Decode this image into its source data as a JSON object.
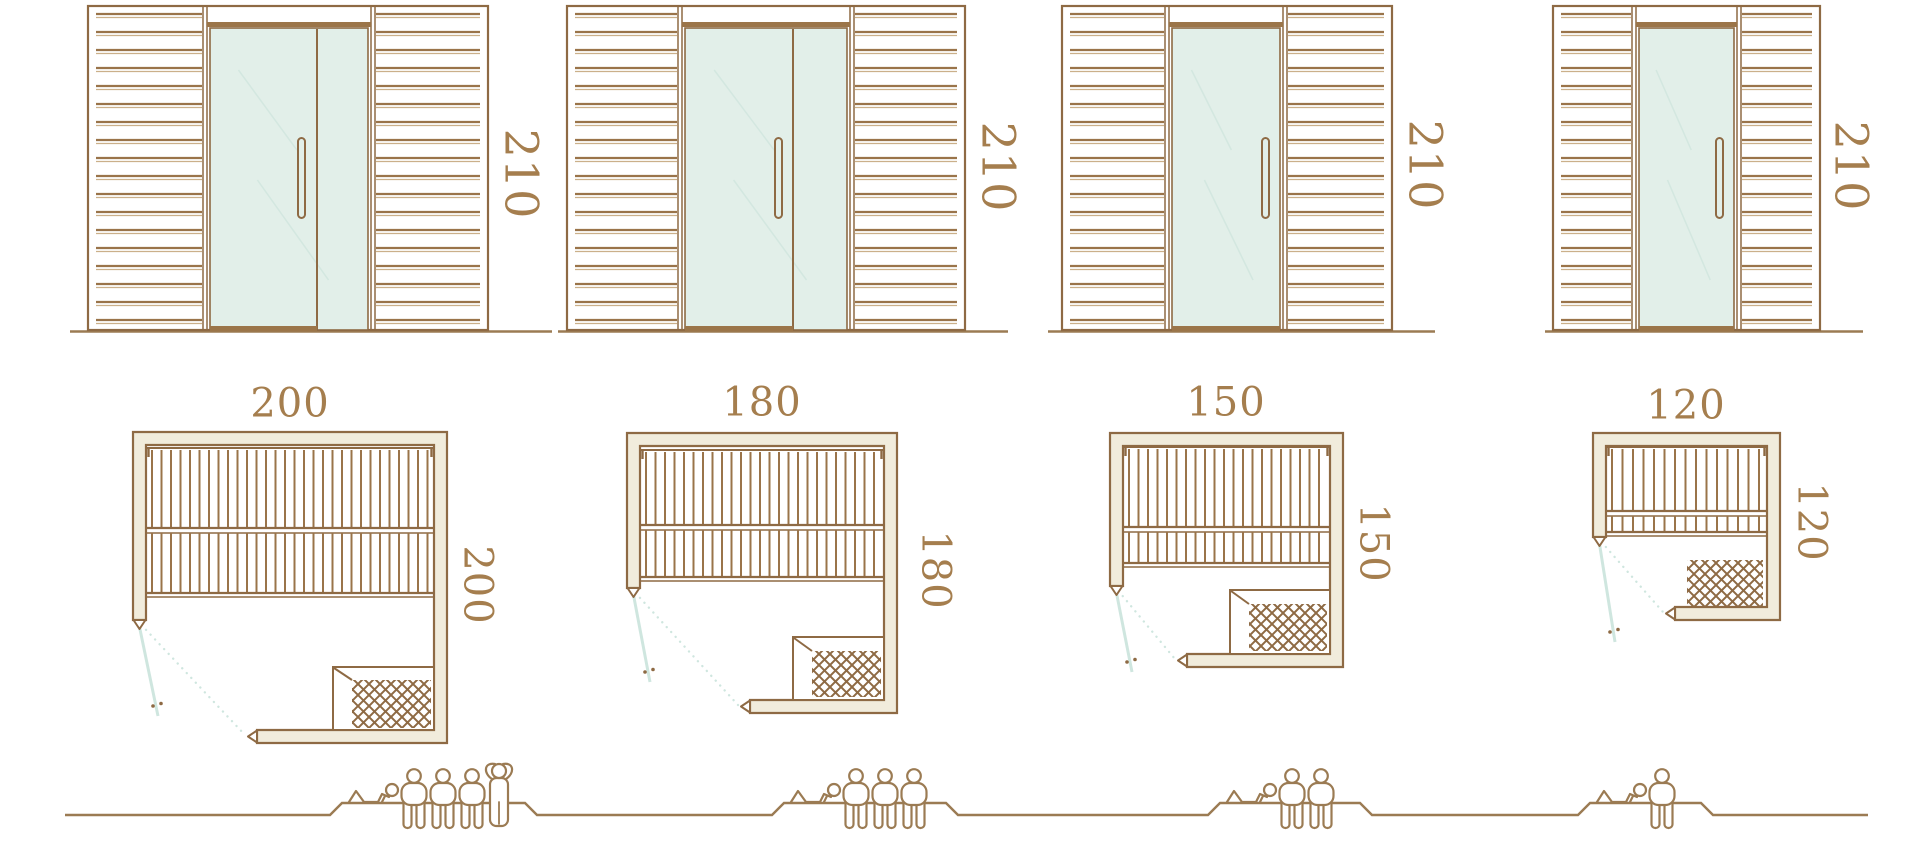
{
  "diagram_title": "sauna-cabin-size-comparison",
  "palette": {
    "line": "#8e6a44",
    "slat": "#9a744a",
    "slat_light": "#cbb08a",
    "wall_fill": "#f1ecdc",
    "glass_fill": "#e2efe9",
    "glass_line": "#8e6a44",
    "reflection": "#d3e7e0",
    "door_swing": "#cfe6df",
    "wood_dark": "#9b7549",
    "ground": "#9b7b53",
    "label": "#a57e4e",
    "background": "#ffffff"
  },
  "units": [
    {
      "id": "200",
      "labels": {
        "height": "210",
        "width": "200",
        "depth": "200"
      },
      "dimensions_cm": {
        "height": 210,
        "width": 200,
        "depth": 200
      },
      "door_glass_panels": 2,
      "heater_framed": true,
      "capacity": {
        "lying": 1,
        "seated": 3,
        "standing": 1,
        "total": 5
      }
    },
    {
      "id": "180",
      "labels": {
        "height": "210",
        "width": "180",
        "depth": "180"
      },
      "dimensions_cm": {
        "height": 210,
        "width": 180,
        "depth": 180
      },
      "door_glass_panels": 2,
      "heater_framed": true,
      "capacity": {
        "lying": 1,
        "seated": 3,
        "standing": 0,
        "total": 4
      }
    },
    {
      "id": "150",
      "labels": {
        "height": "210",
        "width": "150",
        "depth": "150"
      },
      "dimensions_cm": {
        "height": 210,
        "width": 150,
        "depth": 150
      },
      "door_glass_panels": 1,
      "heater_framed": true,
      "capacity": {
        "lying": 1,
        "seated": 2,
        "standing": 0,
        "total": 3
      }
    },
    {
      "id": "120",
      "labels": {
        "height": "210",
        "width": "120",
        "depth": "120"
      },
      "dimensions_cm": {
        "height": 210,
        "width": 120,
        "depth": 120
      },
      "door_glass_panels": 1,
      "heater_framed": false,
      "capacity": {
        "lying": 1,
        "seated": 1,
        "standing": 0,
        "total": 2
      }
    }
  ]
}
